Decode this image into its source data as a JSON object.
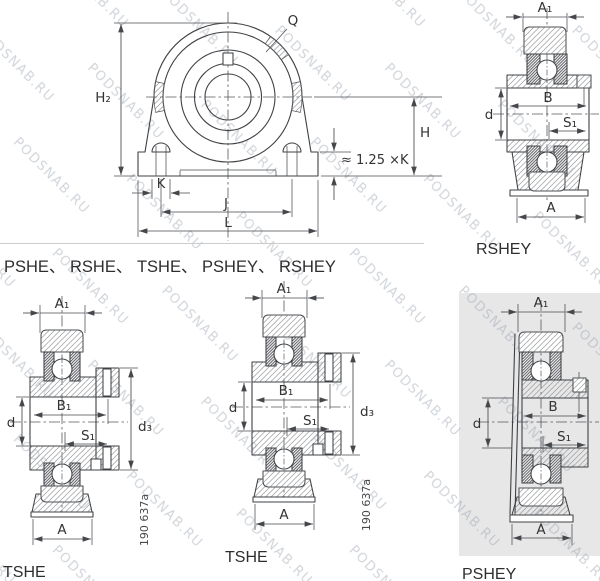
{
  "series_row": "PSHE、 RSHE、 TSHE、 PSHEY、 RSHEY",
  "watermark": "PODSNAB.RU",
  "front_view": {
    "labels": {
      "h2": "H₂",
      "q": "Q",
      "h": "H",
      "base_thickness": "≈ 1.25 ×K",
      "k": "K",
      "j": "J",
      "l": "L"
    }
  },
  "rshey": {
    "title": "RSHEY",
    "labels": {
      "a1": "A₁",
      "b": "B",
      "d": "d",
      "s1": "S₁",
      "a": "A"
    }
  },
  "tshe": {
    "title": "TSHE",
    "labels": {
      "a1": "A₁",
      "b1": "B₁",
      "d": "d",
      "s1": "S₁",
      "d3": "d₃",
      "a": "A"
    },
    "ref_number": "190 637a"
  },
  "pshey": {
    "title": "PSHEY",
    "labels": {
      "a1": "A₁",
      "b": "B",
      "d": "d",
      "s1": "S₁",
      "a": "A"
    }
  },
  "colors": {
    "line": "#3f4145",
    "hatch": "#97999c",
    "label": "#333333",
    "watermark": "#b6bcc6",
    "panel": "#e7e7e8",
    "divider": "#cccccc"
  }
}
